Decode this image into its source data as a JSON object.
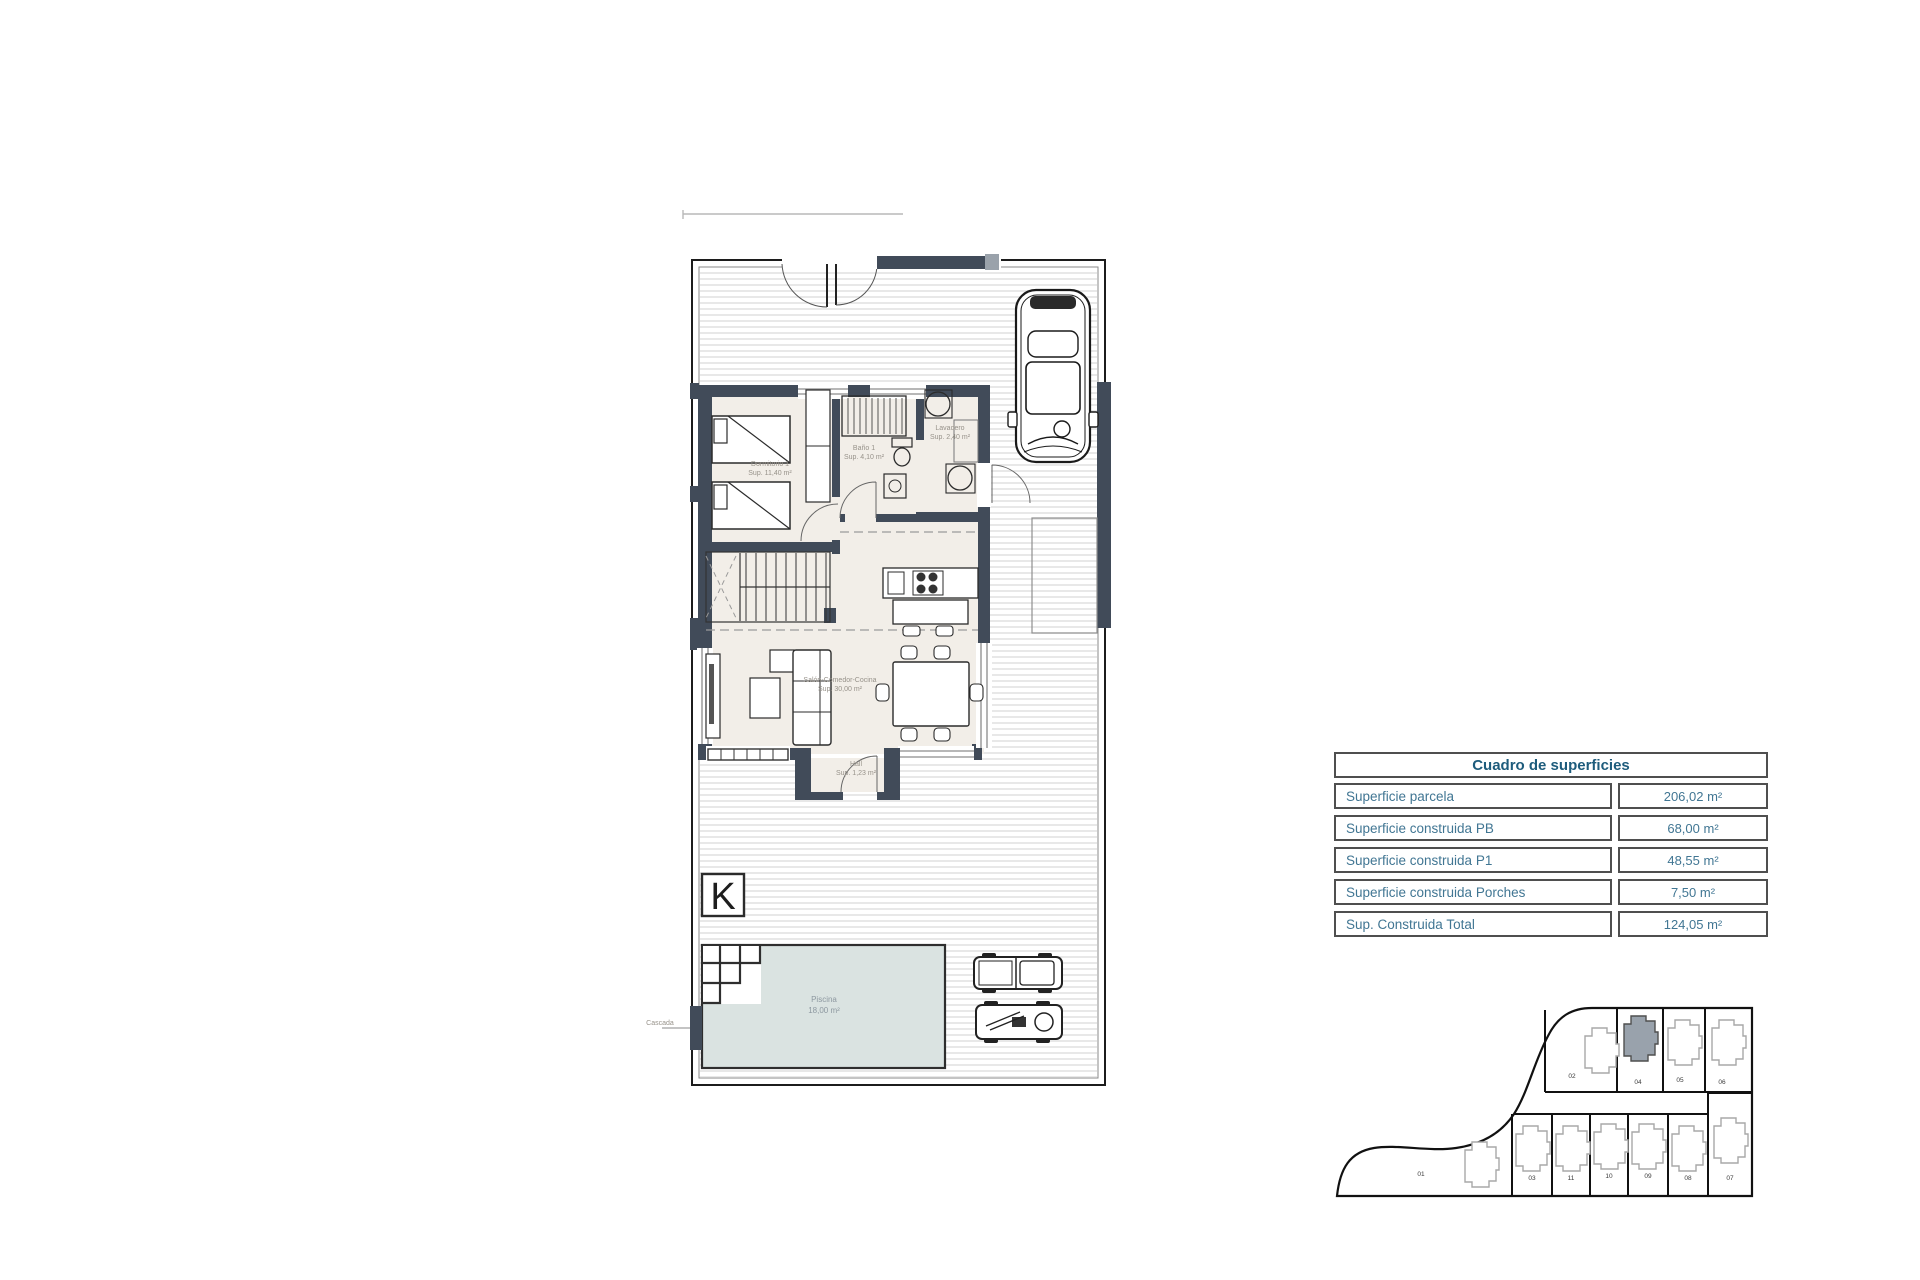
{
  "table": {
    "header": "Cuadro de superficies",
    "rows": [
      {
        "label": "Superficie parcela",
        "value": "206,02 m²"
      },
      {
        "label": "Superficie construida PB",
        "value": "68,00 m²"
      },
      {
        "label": "Superficie construida P1",
        "value": "48,55 m²"
      },
      {
        "label": "Superficie construida Porches",
        "value": "7,50 m²"
      },
      {
        "label": "Sup. Construida Total",
        "value": "124,05 m²"
      }
    ]
  },
  "plan": {
    "k_symbol": "K",
    "cascada_label": "Cascada",
    "rooms": {
      "bedroom": {
        "name": "Dormitorio 1",
        "area": "Sup. 11,40 m²"
      },
      "bathroom": {
        "name": "Baño 1",
        "area": "Sup. 4,10 m²"
      },
      "laundry": {
        "name": "Lavadero",
        "area": "Sup. 2,40 m²"
      },
      "living": {
        "name": "Salón-Comedor-Cocina",
        "area": "Sup. 30,00 m²"
      },
      "hall": {
        "name": "Hall",
        "area": "Sup. 1,23 m²"
      },
      "pool": {
        "name": "Piscina",
        "area": "18,00 m²"
      }
    }
  },
  "siteplan": {
    "big_plot": "01",
    "highlighted_plot": "04",
    "top_row": [
      "02",
      "04",
      "05",
      "06"
    ],
    "bottom_row": [
      "03",
      "11",
      "10",
      "09",
      "08",
      "07"
    ]
  },
  "colors": {
    "wall": "#414b59",
    "accent_text": "#1e5c7c",
    "row_text": "#417693",
    "pool_fill": "#dae3e1",
    "hatch_line": "#d8d8d8",
    "highlight_fill": "#99a2ac"
  }
}
